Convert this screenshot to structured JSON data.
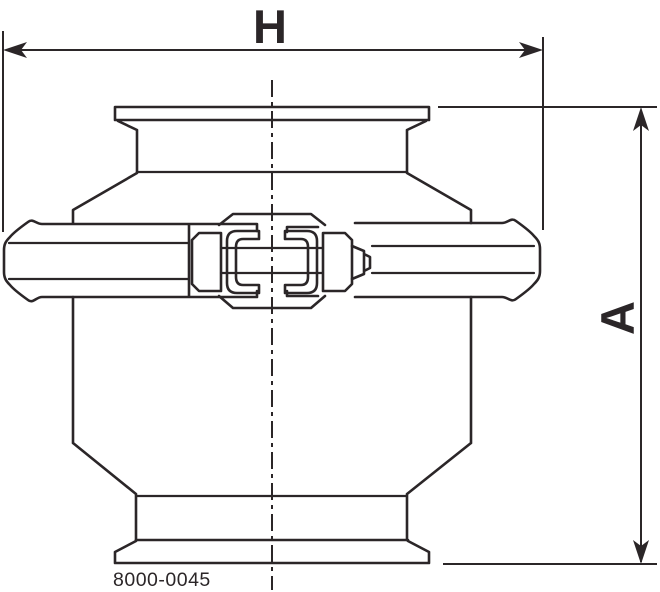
{
  "drawing": {
    "type": "engineering-dimension-drawing",
    "subject": "sanitary check valve with tri-clamp ferrules and heavy clamp ring",
    "dim_width_label": "H",
    "dim_height_label": "A",
    "part_number": "8000-0045",
    "line_color": "#2b2628",
    "background_color": "#ffffff"
  }
}
